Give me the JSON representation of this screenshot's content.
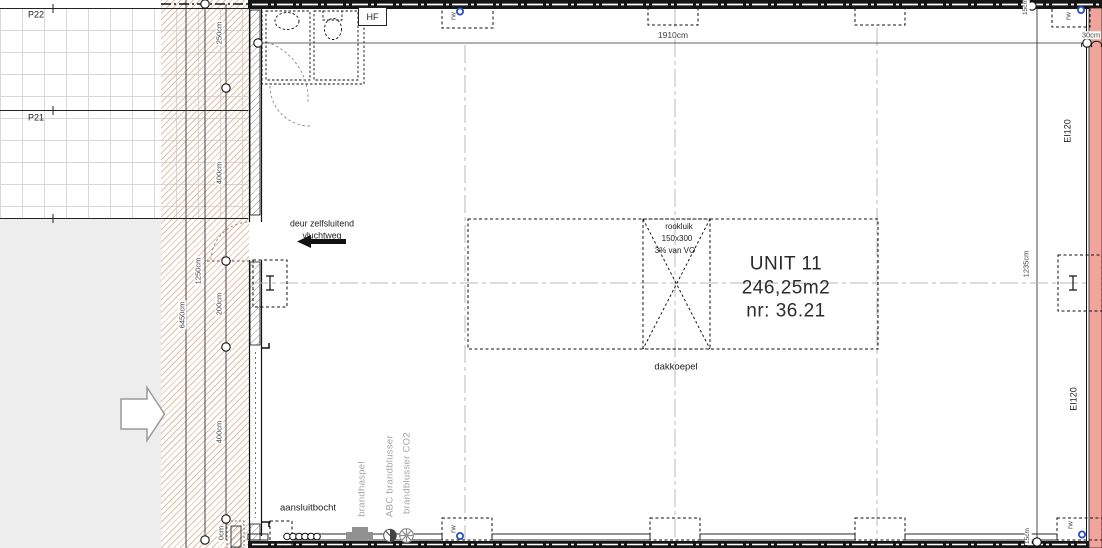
{
  "parking": {
    "p22": "P22",
    "p21": "P21"
  },
  "top": {
    "hf": "HF",
    "width_dim": "1910cm",
    "wall_dim": "30cm",
    "offset_dim": "15cm",
    "rw": "rw"
  },
  "left_dims": {
    "overall": "6450cm",
    "total": "1250cm",
    "seg_250": "250cm",
    "seg_400a": "400cm",
    "seg_200": "200cm",
    "seg_400b": "400cm",
    "seg_0": "0cm"
  },
  "right_dims": {
    "height": "1235cm",
    "offset": "15cm",
    "firewall_class": "EI120",
    "rw": "rw"
  },
  "escape_door": {
    "line1": "deur zelfsluitend",
    "line2": "vluchtweg"
  },
  "unit": {
    "name": "UNIT 11",
    "area": "246,25m2",
    "number": "nr: 36.21"
  },
  "roof": {
    "rookluik": "rookluik",
    "size": "150x300",
    "percentage": "3% van VO",
    "dakkoepel": "dakkoepel"
  },
  "equipment": {
    "aansluitbocht": "aansluitbocht",
    "brandhaspel": "brandhaspel",
    "abc_blusser": "ABC brandblusser",
    "co2_blusser": "brandblusser CO2"
  },
  "colors": {
    "hatch_zone": "#e3bfa6",
    "firewall": "#f1a49c",
    "marker_blue": "#2a52be",
    "paved_area": "#ededed"
  }
}
